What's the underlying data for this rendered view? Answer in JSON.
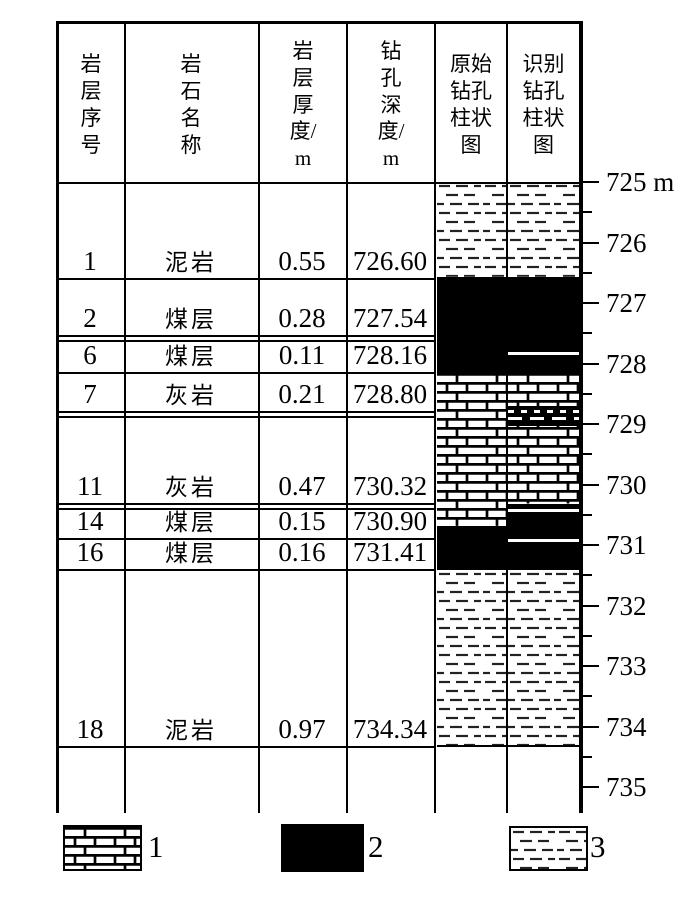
{
  "colors": {
    "ink": "#000000",
    "paper": "#ffffff"
  },
  "table": {
    "headers": [
      {
        "id": "layer-no",
        "label": "岩\n层\n序\n号"
      },
      {
        "id": "rock-name",
        "label": "岩\n石\n名\n称"
      },
      {
        "id": "thickness",
        "label": "岩\n层\n厚\n度/\nm"
      },
      {
        "id": "drill-depth",
        "label": "钻\n孔\n深\n度/\nm"
      },
      {
        "id": "original-log",
        "label": "原始\n钻孔\n柱状\n图"
      },
      {
        "id": "identified-log",
        "label": "识别\n钻孔\n柱状\n图"
      }
    ],
    "rows": [
      {
        "no": "1",
        "name": "泥岩",
        "thickness": "0.55",
        "depth": "726.60"
      },
      {
        "no": "2",
        "name": "煤层",
        "thickness": "0.28",
        "depth": "727.54"
      },
      {
        "no": "6",
        "name": "煤层",
        "thickness": "0.11",
        "depth": "728.16"
      },
      {
        "no": "7",
        "name": "灰岩",
        "thickness": "0.21",
        "depth": "728.80"
      },
      {
        "no": "11",
        "name": "灰岩",
        "thickness": "0.47",
        "depth": "730.32"
      },
      {
        "no": "14",
        "name": "煤层",
        "thickness": "0.15",
        "depth": "730.90"
      },
      {
        "no": "16",
        "name": "煤层",
        "thickness": "0.16",
        "depth": "731.41"
      },
      {
        "no": "18",
        "name": "泥岩",
        "thickness": "0.97",
        "depth": "734.34"
      }
    ]
  },
  "chart_data": {
    "type": "stratigraphic-column",
    "depth_unit": "m",
    "depth_axis": {
      "start": 725,
      "end": 735,
      "major_tick_interval": 1,
      "minor_tick_interval": 0.5,
      "tick_labels": [
        "725 m",
        "726",
        "727",
        "728",
        "729",
        "730",
        "731",
        "732",
        "733",
        "734",
        "735"
      ]
    },
    "lithology_legend_codes": {
      "limestone": "1",
      "coal": "2",
      "mudstone": "3"
    },
    "columns": [
      {
        "name": "original_log",
        "bands": [
          {
            "lithology": "mudstone",
            "top": 725.0,
            "bottom": 726.6
          },
          {
            "lithology": "coal",
            "top": 726.6,
            "bottom": 728.16
          },
          {
            "lithology": "limestone",
            "top": 728.16,
            "bottom": 730.72
          },
          {
            "lithology": "coal",
            "top": 730.72,
            "bottom": 731.41
          },
          {
            "lithology": "mudstone",
            "top": 731.41,
            "bottom": 734.34
          }
        ],
        "marks": []
      },
      {
        "name": "identified_log",
        "bands": [
          {
            "lithology": "mudstone",
            "top": 725.0,
            "bottom": 726.6
          },
          {
            "lithology": "coal",
            "top": 726.6,
            "bottom": 728.16
          },
          {
            "lithology": "limestone",
            "top": 728.16,
            "bottom": 730.35
          },
          {
            "lithology": "coal",
            "top": 730.35,
            "bottom": 731.41
          },
          {
            "lithology": "mudstone",
            "top": 731.41,
            "bottom": 734.34
          }
        ],
        "marks": [
          {
            "type": "white-separator",
            "depth": 727.83
          },
          {
            "type": "boundary-band",
            "top": 728.7,
            "bottom": 729.03
          },
          {
            "type": "white-separator",
            "depth": 730.43
          },
          {
            "type": "white-separator",
            "depth": 730.93
          }
        ]
      }
    ]
  },
  "legend": {
    "items": [
      {
        "label": "1",
        "lithology": "limestone"
      },
      {
        "label": "2",
        "lithology": "coal"
      },
      {
        "label": "3",
        "lithology": "mudstone"
      }
    ]
  }
}
